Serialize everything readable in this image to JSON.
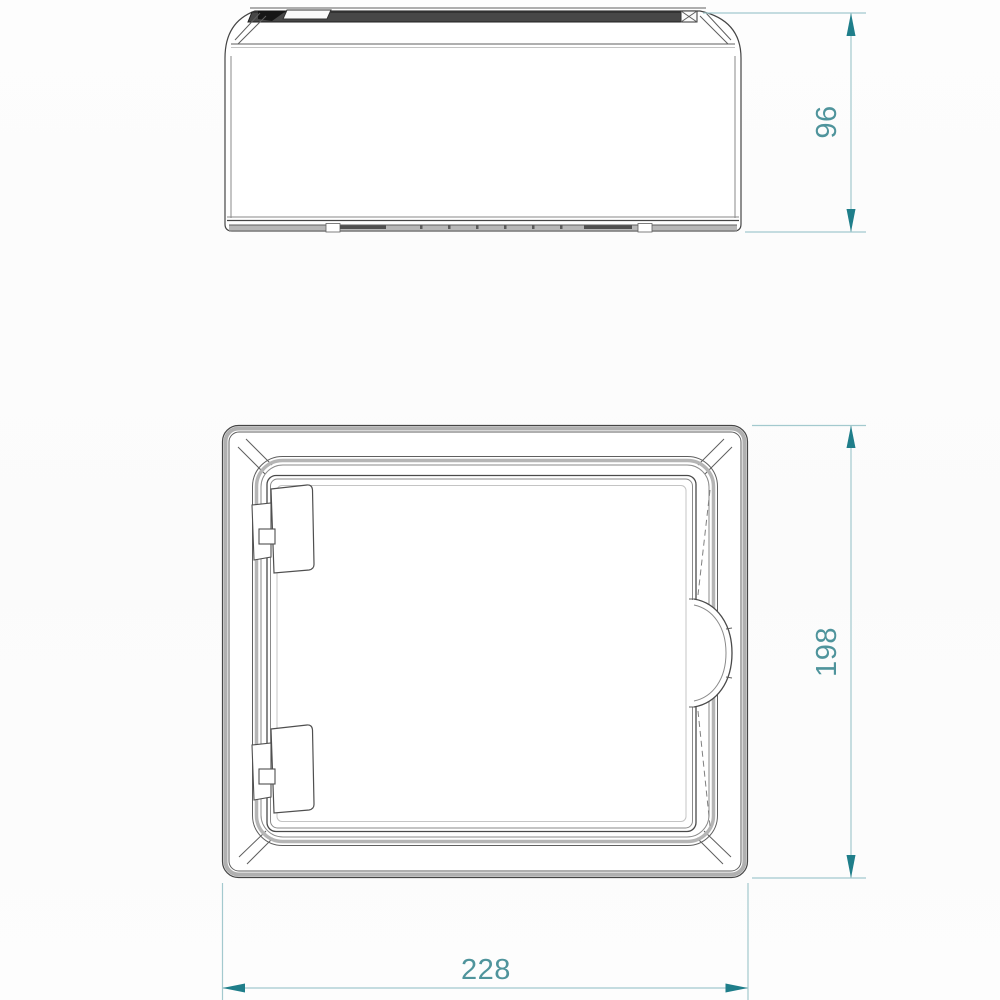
{
  "dimensions": {
    "side_height": {
      "value": "96",
      "orientation": "vertical"
    },
    "front_height": {
      "value": "198",
      "orientation": "vertical"
    },
    "front_width": {
      "value": "228",
      "orientation": "horizontal"
    }
  },
  "colors": {
    "dim_line": "#a3c9ce",
    "dim_arrow": "#1f7e8a",
    "dim_text": "#4f949c",
    "outline": "#454545",
    "edge_gray": "#b0b0b0",
    "band_dark": "#474747"
  }
}
